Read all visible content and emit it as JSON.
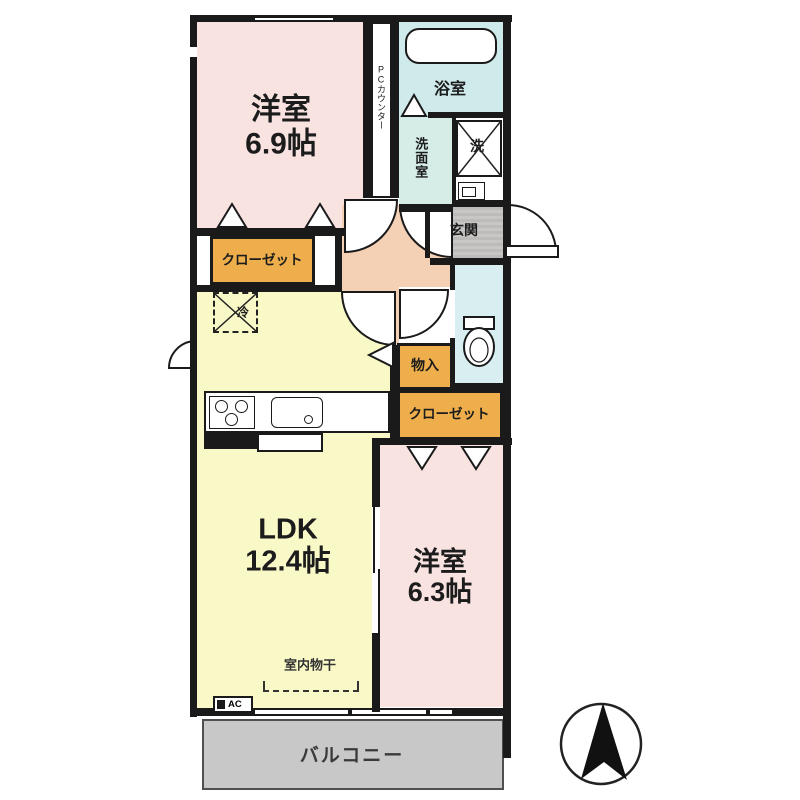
{
  "plan": {
    "rooms": {
      "west_room_1": {
        "name": "洋室",
        "size": "6.9帖"
      },
      "ldk": {
        "name": "LDK",
        "size": "12.4帖"
      },
      "west_room_2": {
        "name": "洋室",
        "size": "6.3帖"
      },
      "bath": {
        "label": "浴室"
      },
      "washroom": {
        "label": "洗面室"
      },
      "washer": {
        "label": "洗"
      },
      "entrance": {
        "label": "玄関"
      },
      "storage": {
        "label": "物入"
      },
      "closet_left": {
        "label": "クローゼット"
      },
      "closet_right": {
        "label": "クローゼット"
      },
      "balcony": {
        "label": "バルコニー"
      }
    },
    "fixtures": {
      "pc_counter": {
        "label": "PCカウンター"
      },
      "refrigerator": {
        "label": "冷"
      },
      "indoor_drying": {
        "label": "室内物干"
      },
      "air_conditioner": {
        "label": "AC"
      }
    },
    "colors": {
      "room_pink": "#f8e3e1",
      "ldk_yellow": "#f9f9c8",
      "bath_blue": "#cfeaea",
      "washroom_teal": "#d5ece7",
      "toilet_blue": "#d9eef1",
      "hall_peach": "#f4d0b5",
      "closet_orange": "#eeae4c",
      "entrance_gray": "#c3c2c1",
      "balcony_gray": "#c9c8c8",
      "wall_black": "#1a1a1a"
    }
  }
}
